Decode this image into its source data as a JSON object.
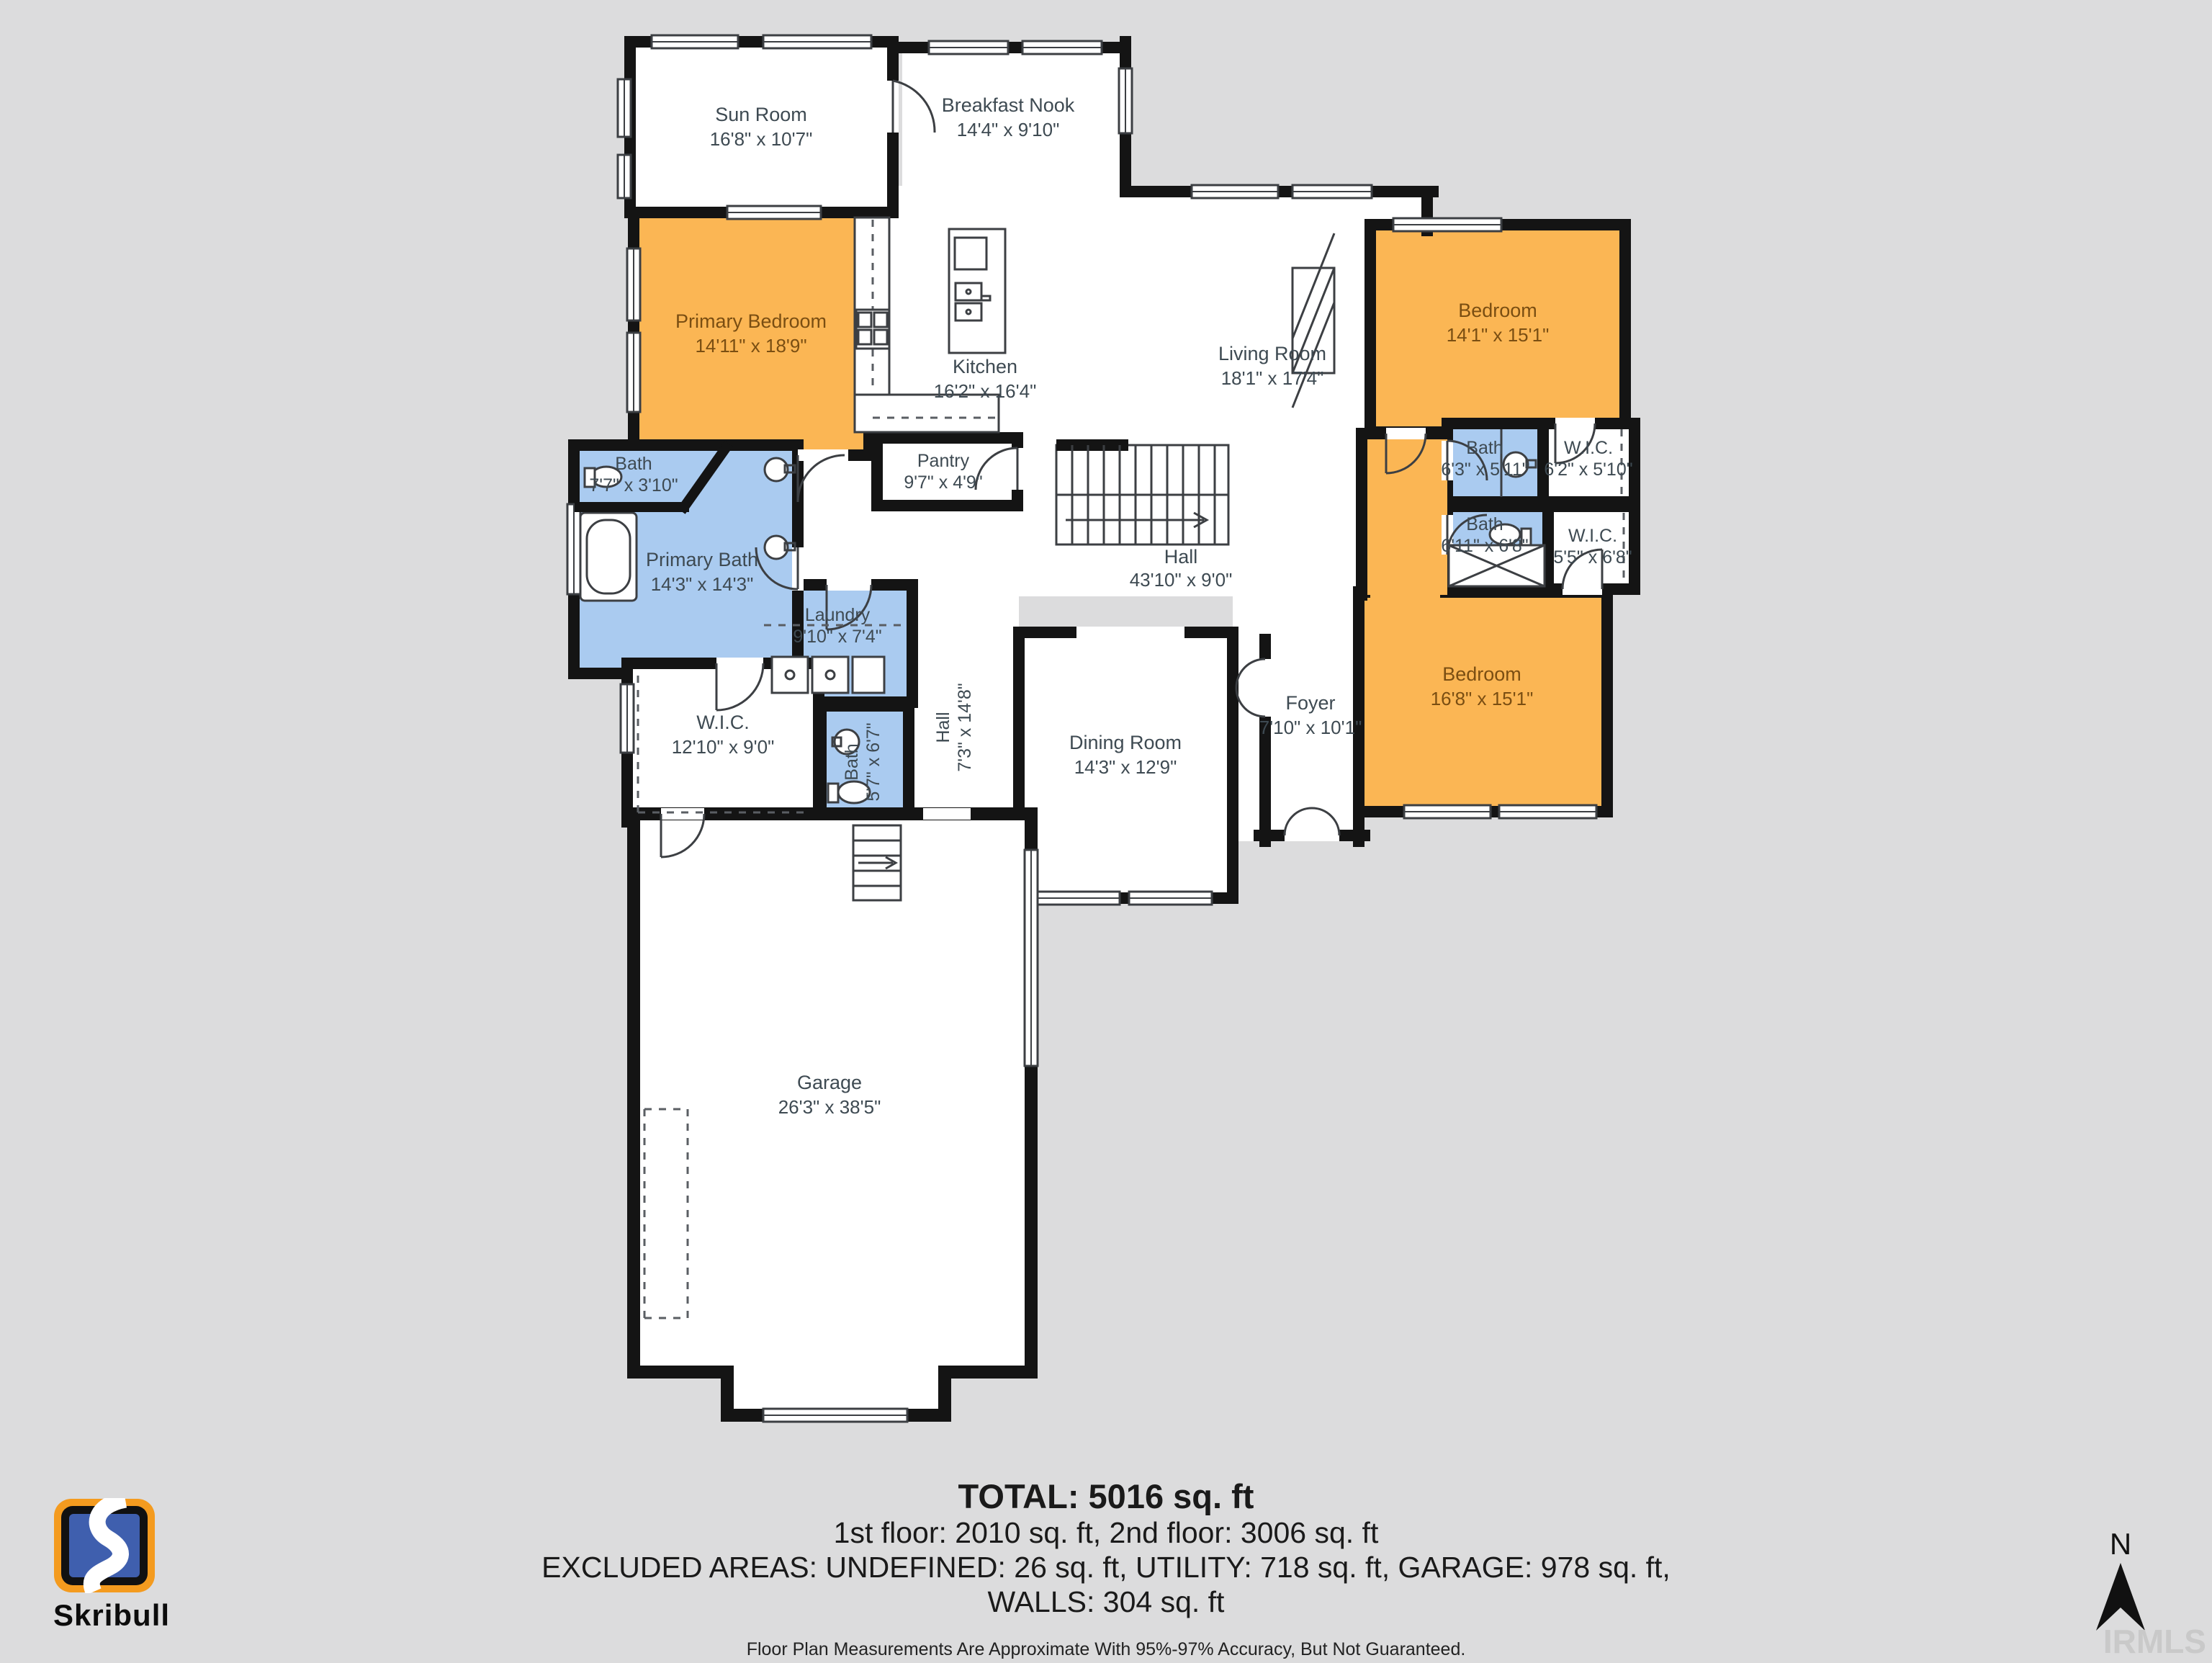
{
  "colors": {
    "background": "#DCDCDD",
    "room_fill": "#FFFFFF",
    "bedroom_fill": "#FBB654",
    "bath_fill": "#AACBF0",
    "wall": "#141414",
    "label": "#3E4A52",
    "bedroom_label": "#7A4E12",
    "logo_orange": "#F49B1F",
    "logo_blue": "#3F5FAE"
  },
  "branding": {
    "logo_text": "Skribull",
    "watermark": "IRMLS"
  },
  "compass": {
    "north_label": "N"
  },
  "rooms": {
    "sun_room": {
      "name": "Sun Room",
      "dims": "16'8\" x 10'7\""
    },
    "breakfast_nook": {
      "name": "Breakfast Nook",
      "dims": "14'4\" x 9'10\""
    },
    "primary_bedroom": {
      "name": "Primary Bedroom",
      "dims": "14'11\" x 18'9\""
    },
    "kitchen": {
      "name": "Kitchen",
      "dims": "16'2\" x 16'4\""
    },
    "living_room": {
      "name": "Living Room",
      "dims": "18'1\" x 17'4\""
    },
    "pantry": {
      "name": "Pantry",
      "dims": "9'7\" x 4'9\""
    },
    "hall_upper": {
      "name": "Hall",
      "dims": "43'10\" x 9'0\""
    },
    "bath_small": {
      "name": "Bath",
      "dims": "7'7\" x 3'10\""
    },
    "primary_bath": {
      "name": "Primary Bath",
      "dims": "14'3\" x 14'3\""
    },
    "laundry": {
      "name": "Laundry",
      "dims": "9'10\" x 7'4\""
    },
    "hall_lower": {
      "name": "Hall",
      "dims": "7'3\" x 14'8\""
    },
    "wic_left": {
      "name": "W.I.C.",
      "dims": "12'10\" x 9'0\""
    },
    "bath_lower": {
      "name": "Bath",
      "dims": "5'7\" x 6'7\""
    },
    "dining_room": {
      "name": "Dining Room",
      "dims": "14'3\" x 12'9\""
    },
    "foyer": {
      "name": "Foyer",
      "dims": "7'10\" x 10'1\""
    },
    "bedroom_top": {
      "name": "Bedroom",
      "dims": "14'1\" x 15'1\""
    },
    "bath_top": {
      "name": "Bath",
      "dims": "6'3\" x 5'11\""
    },
    "wic_top": {
      "name": "W.I.C.",
      "dims": "6'2\" x 5'10\""
    },
    "bath_mid": {
      "name": "Bath",
      "dims": "6'11\" x 6'8\""
    },
    "wic_mid": {
      "name": "W.I.C.",
      "dims": "5'5\" x 6'8\""
    },
    "bedroom_bottom": {
      "name": "Bedroom",
      "dims": "16'8\" x 15'1\""
    },
    "garage": {
      "name": "Garage",
      "dims": "26'3\" x 38'5\""
    }
  },
  "summary": {
    "total": "TOTAL: 5016 sq. ft",
    "floors": "1st floor: 2010 sq. ft, 2nd floor: 3006 sq. ft",
    "excluded": "EXCLUDED AREAS: UNDEFINED: 26 sq. ft, UTILITY: 718 sq. ft, GARAGE: 978 sq. ft,",
    "walls": "WALLS: 304 sq. ft",
    "disclaimer": "Floor Plan Measurements Are Approximate With 95%-97% Accuracy, But Not Guaranteed."
  }
}
